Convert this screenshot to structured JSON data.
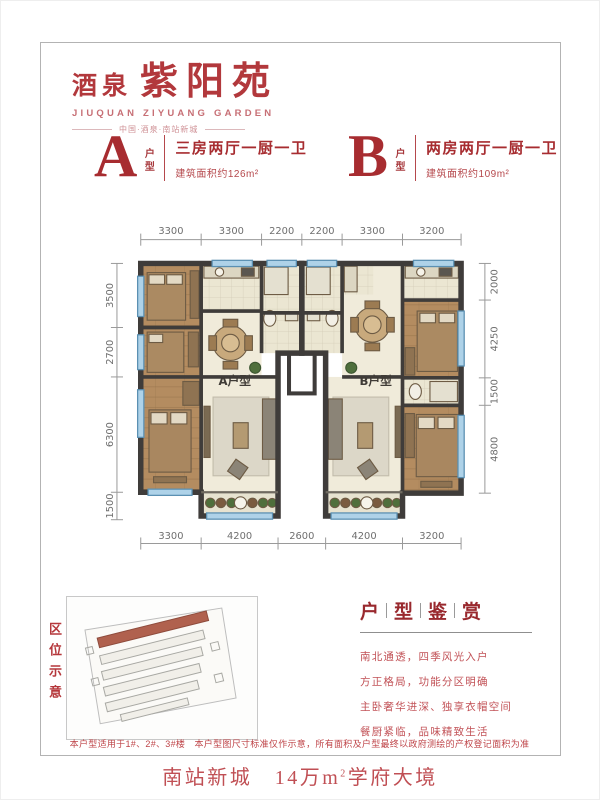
{
  "logo": {
    "brand_prefix": "酒泉",
    "brand_name": "紫阳苑",
    "brand_en": "JIUQUAN ZIYUANG GARDEN",
    "tagline": "中国·酒泉·南站新城"
  },
  "units": [
    {
      "letter": "A",
      "type_label": "户型",
      "rooms": "三房两厅一厨一卫",
      "area": "建筑面积约126m²"
    },
    {
      "letter": "B",
      "type_label": "户型",
      "rooms": "两房两厅一厨一卫",
      "area": "建筑面积约109m²"
    }
  ],
  "floor_plan": {
    "label_a": "A户型",
    "label_b": "B户型",
    "dims": {
      "top": [
        3300,
        3300,
        2200,
        2200,
        3300,
        3200
      ],
      "bottom": [
        3300,
        4200,
        2600,
        4200,
        3200
      ],
      "left": [
        3500,
        2700,
        6300,
        1500
      ],
      "right": [
        2000,
        4250,
        1500,
        4800
      ]
    }
  },
  "site_map": {
    "label": "区位示意"
  },
  "appreciation": {
    "title_chars": [
      "户",
      "型",
      "鉴",
      "赏"
    ],
    "lines": [
      "南北通透，四季风光入户",
      "方正格局，功能分区明确",
      "主卧奢华进深、独享衣帽空间",
      "餐厨紧临，品味精致生活"
    ]
  },
  "disclaimer": "本户型适用于1#、2#、3#楼　本户型图尺寸标准仅作示意，所有面积及户型最终以政府测绘的产权登记面积为准",
  "footer": {
    "part1": "南站新城",
    "part2": "　14万m",
    "sup": "2",
    "part3": "学府大境"
  },
  "colors": {
    "accent_red": "#a72c30",
    "footer_red": "#c04f54",
    "wall": "#3f3c3a",
    "window_blue": "#aed2e8"
  }
}
